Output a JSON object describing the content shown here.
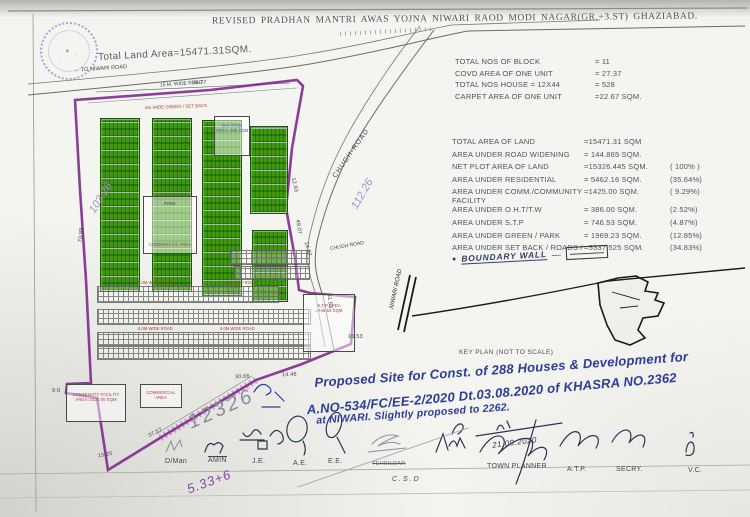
{
  "title": "REVISED PRADHAN MANTRI AWAS YOJNA NIWARI RAOD MODI NAGAR(GR.+3.ST)  GHAZIABAD.",
  "plan": {
    "total_land_area": "Total Land Area=15471.31SQM.",
    "labels": {
      "to_niwari_road": "← TO NIWARI ROAD",
      "road_15m": "15 M. WIDE ROAD",
      "set_back": "8m WIDE GREEN / SET BACK",
      "chugh_road_upper": "CHUGH-ROAD",
      "chugh_road_lower": "CHUGH ROAD",
      "niwari_road": "NIWARI ROAD",
      "park": "PARK",
      "commercial_center": "COMMERCIAL AREA",
      "commercial_lower": "COMMERCIAL AREA",
      "community_line1": "COMMUNITY FACILITY",
      "community_line2": "AREA=1425.00 SQM",
      "oht_line1": "O.H.T/T.W",
      "oht_line2": "AREA=386 SQM",
      "stp_line1": "S.T.P AREA",
      "stp_line2": "=746.53 SQM",
      "road_6m": "6.0M WIDE ROAD"
    },
    "dims": [
      "35.77",
      "70.89",
      "12.93",
      "49.07",
      "14.67",
      "31.53",
      "10.53",
      "14.46",
      "30.66",
      "37.57",
      "15.25",
      "9.0"
    ],
    "handwritten": {
      "left_number": "103.26",
      "right_number": "112.26",
      "pencil_number": "12326",
      "bottom_number": "5.33+6"
    }
  },
  "unit_stats": {
    "rows": [
      {
        "label": "TOTAL NOS OF BLOCK",
        "value": "=   11"
      },
      {
        "label": "COVD AREA OF ONE UNIT",
        "value": "= 27.37"
      },
      {
        "label": "TOTAL NOS HOUSE = 12X44",
        "value": "=   528"
      },
      {
        "label": "CARPET AREA OF ONE UNIT",
        "value": "=22.67 SQM."
      }
    ]
  },
  "area_statement": {
    "rows": [
      {
        "label": "TOTAL AREA OF LAND",
        "value": "=15471.31  SQM",
        "pct": ""
      },
      {
        "label": "AREA UNDER ROAD WIDENING",
        "value": "=  144.865 SQM.",
        "pct": ""
      },
      {
        "label": "NET PLOT AREA OF LAND",
        "value": "=15326.445 SQM.",
        "pct": "( 100% )"
      },
      {
        "label": "AREA UNDER RESIDENTIAL",
        "value": "= 5462.16  SQM.",
        "pct": "(35.64%)"
      },
      {
        "label": "AREA UNDER COMM./COMMUNITY FACILITY",
        "value": "=1425.00 SQM.",
        "pct": "( 9.29%)"
      },
      {
        "label": "AREA UNDER O.H.T/T.W",
        "value": "=  386.00 SQM.",
        "pct": "(2.52%)"
      },
      {
        "label": "AREA UNDER S.T.P",
        "value": "=  746.53 SQM.",
        "pct": "(4.87%)"
      },
      {
        "label": "AREA UNDER GREEN / PARK",
        "value": "= 1969.23 SQM.",
        "pct": "(12.85%)"
      },
      {
        "label": "AREA UNDER SET BACK / ROADS /",
        "value": "=5337.525 SQM.",
        "pct": "(34.83%)"
      }
    ]
  },
  "legend": {
    "boundary_wall": "BOUNDARY WALL",
    "dash": "—",
    "bullet": "●"
  },
  "key_plan": {
    "caption": "KEY PLAN (NOT TO SCALE)"
  },
  "notes": {
    "line1": "Proposed Site for Const. of 288 Houses & Development for",
    "line2": "A.NO-534/FC/EE-2/2020 Dt.03.08.2020 of KHASRA NO.2362",
    "line3": "at NIWARI. Slightly proposed to 2262."
  },
  "signatures": {
    "date": "21.09.2020",
    "labels": [
      "D/Man",
      "AMIN",
      "J.E.",
      "A.E.",
      "E.E.",
      "TEHSILDAR",
      "C.S.D",
      "TOWN PLANNER",
      "A.T.P.",
      "SECRY.",
      "V.C."
    ]
  }
}
